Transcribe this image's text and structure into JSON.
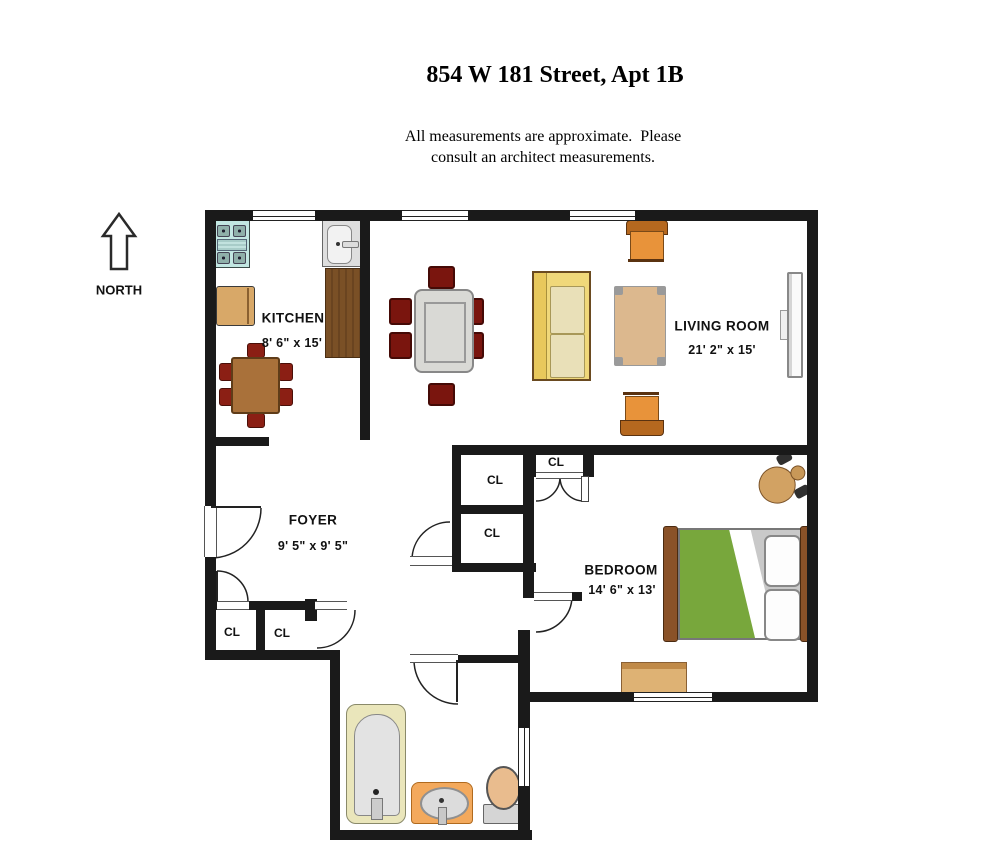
{
  "title": "854 W 181 Street, Apt 1B",
  "disclaimer_line1": "All measurements are approximate.  Please",
  "disclaimer_line2": "consult an architect measurements.",
  "compass_label": "NORTH",
  "rooms": {
    "kitchen": {
      "name": "KITCHEN",
      "dims": "8' 6\" x 15'"
    },
    "living_room": {
      "name": "LIVING ROOM",
      "dims": "21' 2\" x 15'"
    },
    "foyer": {
      "name": "FOYER",
      "dims": "9' 5\" x 9' 5\""
    },
    "bedroom": {
      "name": "BEDROOM",
      "dims": "14' 6\" x 13'"
    }
  },
  "closets": {
    "foyer_left": "CL",
    "foyer_right": "CL",
    "hall_upper": "CL",
    "hall_lower": "CL",
    "bedroom": "CL"
  },
  "colors": {
    "wall": "#1a1a1a",
    "chair_red": "#8b1f14",
    "chair_red_dark": "#7a150e",
    "wood_mid": "#a9713a",
    "counter_wood": "#7a5026",
    "cabinet_tan": "#d8a868",
    "stove_cyan": "#c2e7e2",
    "sofa_yellow": "#f0d87a",
    "cushion_beige": "#e9e0b8",
    "armchair_orange": "#e8933a",
    "armchair_back": "#b5681f",
    "table_gray": "#d9d9d5",
    "coffee_tan": "#dcb88e",
    "bed_green": "#78a73c",
    "bed_post": "#8a5228",
    "dresser_tan": "#deb274",
    "tub_cream": "#eae6bb",
    "vanity_orange": "#f3a95c",
    "toilet_peach": "#e9bc8e"
  }
}
